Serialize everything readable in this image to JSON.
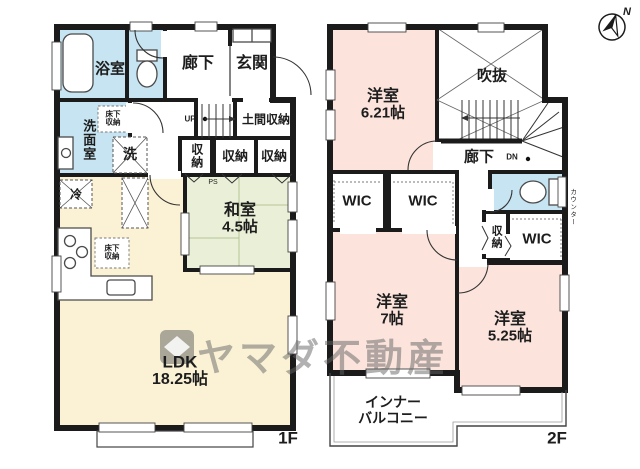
{
  "compass": {
    "north_label": "N"
  },
  "watermark": {
    "brand": "ヤマダ不動産"
  },
  "floor1": {
    "label": "1F",
    "rooms": {
      "bath": "浴室",
      "hallway": "廊下",
      "entrance": "玄関",
      "washroom": "洗面室",
      "underfloor_storage_wash": "床下収納",
      "laundry": "洗",
      "stairs_up": "UP",
      "doma_storage": "土間収納",
      "closet_a": "収納",
      "closet_b": "収納",
      "closet_c": "収納",
      "pipe_space": "PS",
      "fridge": "冷",
      "washitsu_name": "和室",
      "washitsu_size": "4.5帖",
      "underfloor_storage_kitchen": "床下収納",
      "ldk_name": "LDK",
      "ldk_size": "18.25帖"
    }
  },
  "floor2": {
    "label": "2F",
    "rooms": {
      "bedroom1_name": "洋室",
      "bedroom1_size": "6.21帖",
      "void": "吹抜",
      "hallway": "廊下",
      "stairs_down": "DN",
      "wic_a": "WIC",
      "wic_b": "WIC",
      "closet_d": "収納",
      "wic_c": "WIC",
      "counter": "カウンター",
      "bedroom2_name": "洋室",
      "bedroom2_size": "7帖",
      "bedroom3_name": "洋室",
      "bedroom3_size": "5.25帖",
      "balcony_line1": "インナー",
      "balcony_line2": "バルコニー"
    }
  },
  "colors": {
    "wall": "#1b1b1b",
    "water_rooms": "#c7e4f2",
    "western_rooms": "#fce4dd",
    "tatami_room": "#eaf0d8",
    "ldk": "#fbf2d6"
  }
}
